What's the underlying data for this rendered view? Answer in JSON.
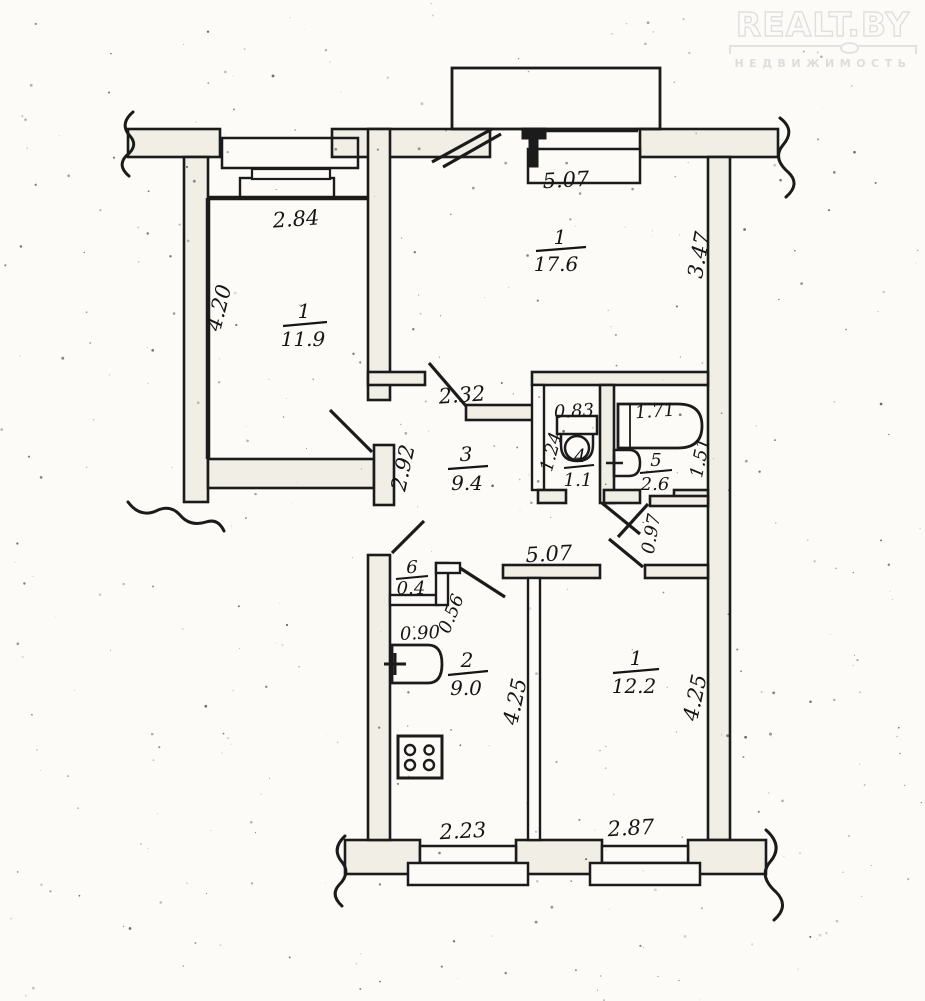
{
  "watermark": {
    "brand": "REALT.BY",
    "subtitle": "НЕДВИЖИМОСТЬ"
  },
  "rooms": {
    "living": {
      "number": "1",
      "area": "11.9"
    },
    "big_room": {
      "number": "1",
      "area": "17.6"
    },
    "corridor": {
      "number": "3",
      "area": "9.4"
    },
    "wc": {
      "number": "4",
      "area": "1.1"
    },
    "bath": {
      "number": "5",
      "area": "2.6"
    },
    "niche": {
      "number": "6",
      "area": "0.4"
    },
    "kitchen": {
      "number": "2",
      "area": "9.0"
    },
    "bedroom": {
      "number": "1",
      "area": "12.2"
    }
  },
  "dims": {
    "living_width": "2.84",
    "living_depth": "4.20",
    "big_room_width": "5.07",
    "big_room_depth": "3.47",
    "corridor_width": "2.32",
    "corridor_doorway": "2.92",
    "wc_width": "0.83",
    "wc_depth": "1.24",
    "bath_width": "1.71",
    "bath_depth": "1.51",
    "closet_wall": "0.97",
    "niche_width": "0.90",
    "niche_depth": "0.56",
    "hall_length": "5.07",
    "kitchen_depth": "4.25",
    "kitchen_window": "2.23",
    "bedroom_depth": "4.25",
    "bedroom_window": "2.87"
  }
}
